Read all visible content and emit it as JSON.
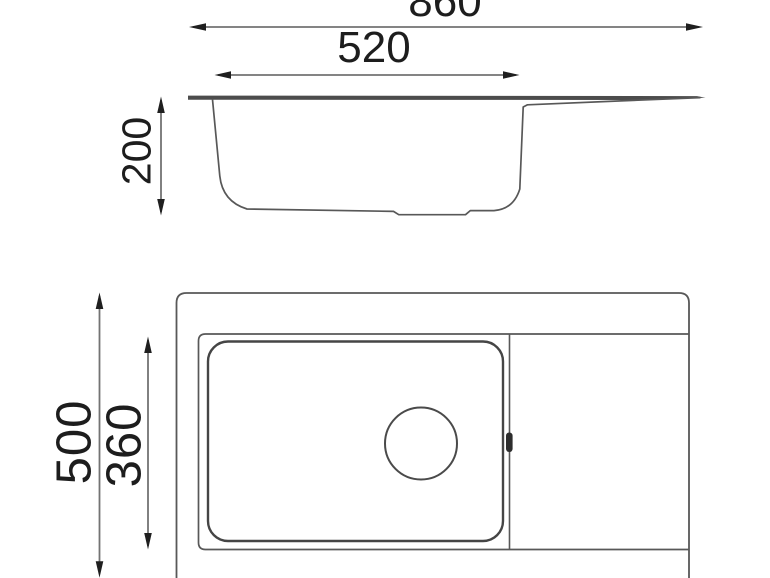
{
  "meta": {
    "type": "technical-dimension-drawing",
    "subject": "kitchen sink with bowl and drainboard, side section view and plan view"
  },
  "colors": {
    "background": "#ffffff",
    "drawing_line": "#585858",
    "bowl_line": "#454545",
    "rim_fill": "#4c4c4c",
    "dimension_line": "#737373",
    "arrow": "#1f1f1f",
    "text": "#1d1d1d"
  },
  "dimensions": {
    "overall_width": "860",
    "bowl_width": "520",
    "bowl_depth": "200",
    "overall_length": "500",
    "bowl_length": "360"
  }
}
